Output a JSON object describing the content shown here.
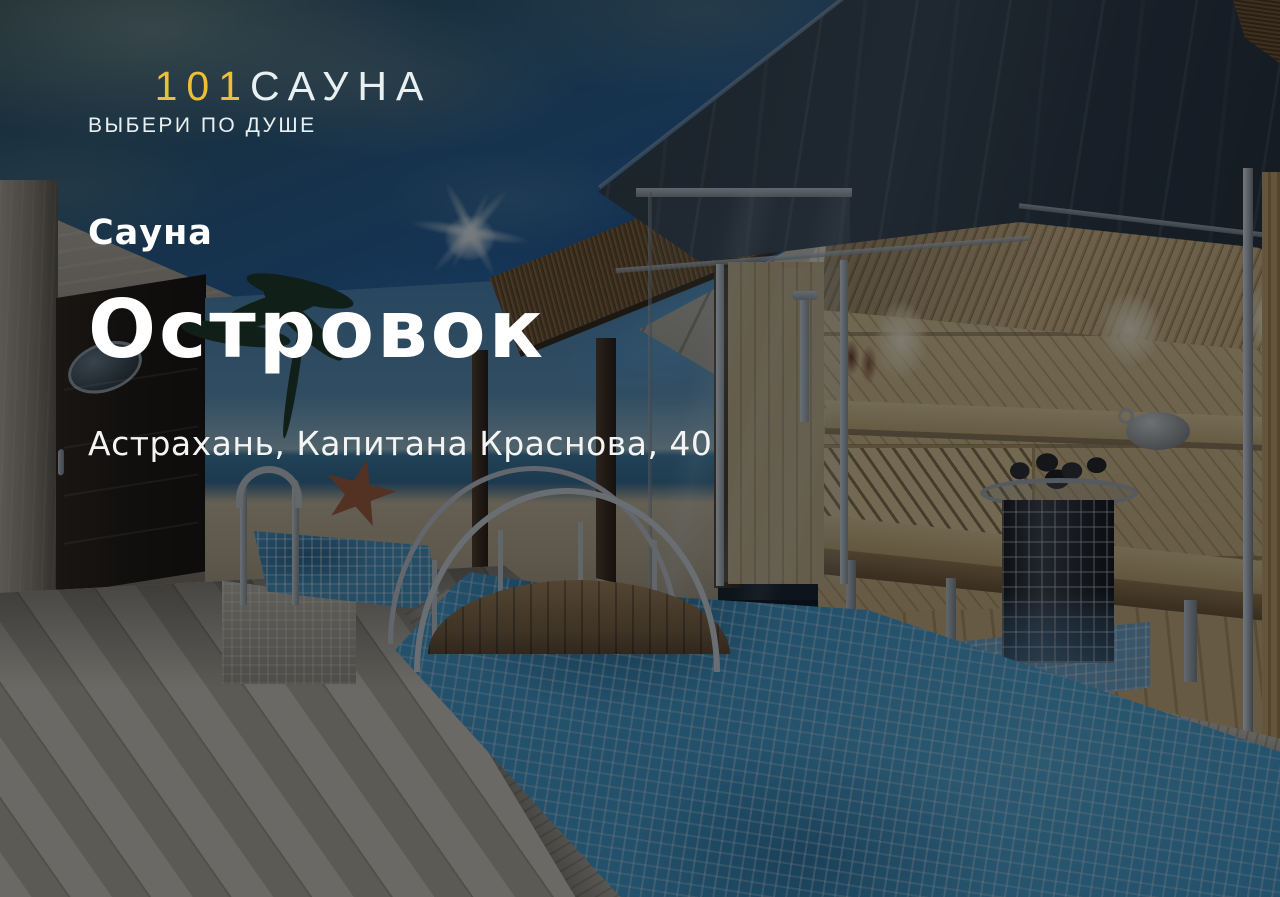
{
  "brand": {
    "logo_number": "101",
    "logo_word": "САУНА",
    "tagline": "ВЫБЕРИ ПО ДУШЕ"
  },
  "listing": {
    "category": "Сауна",
    "title": "Островок",
    "address": "Астрахань, Капитана Краснова, 40"
  },
  "colors": {
    "accent_yellow": "#EDBF37",
    "logo_text": "#E9F0F2",
    "text_primary": "#FFFFFF"
  }
}
